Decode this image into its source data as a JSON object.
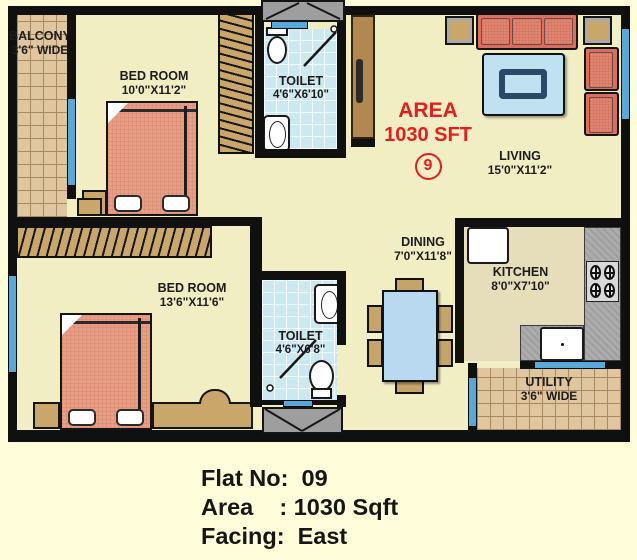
{
  "title": "Apartment floor plan - Flat 09",
  "colors": {
    "background": "#FFFCDA",
    "wall": "#101010",
    "floor": "#F1EEC4",
    "kitchen_floor": "#E6DDBA",
    "tile_tan": "#DFC69E",
    "tile_blue": "#CCE8F0",
    "window_blue": "#58A9DB",
    "wood_tan": "#C9A76B",
    "bed_salmon": "#EA9D83",
    "sofa_red": "#D96F5E",
    "table_blue": "#B9D9F1",
    "counter_gray": "#ACACAC",
    "accent_red": "#E21E1E",
    "door_brown": "#B08850"
  },
  "rooms": {
    "balcony": {
      "name": "BALCONY",
      "dims": "3'6\" WIDE"
    },
    "bedroom1": {
      "name": "BED ROOM",
      "dims": "10'0\"X11'2\""
    },
    "toilet1": {
      "name": "TOILET",
      "dims": "4'6\"X6'10\""
    },
    "living": {
      "name": "LIVING",
      "dims": "15'0\"X11'2\""
    },
    "bedroom2": {
      "name": "BED ROOM",
      "dims": "13'6\"X11'6\""
    },
    "toilet2": {
      "name": "TOILET",
      "dims": "4'6\"X6'8\""
    },
    "dining": {
      "name": "DINING",
      "dims": "7'0\"X11'8\""
    },
    "kitchen": {
      "name": "KITCHEN",
      "dims": "8'0\"X7'10\""
    },
    "utility": {
      "name": "UTILITY",
      "dims": "3'6\" WIDE"
    }
  },
  "area_badge": {
    "line1": "AREA",
    "line2": "1030 SFT",
    "flat_number": "9"
  },
  "info": {
    "line1": "Flat No:  09",
    "line2": "Area    : 1030 Sqft",
    "line3": "Facing:  East"
  }
}
